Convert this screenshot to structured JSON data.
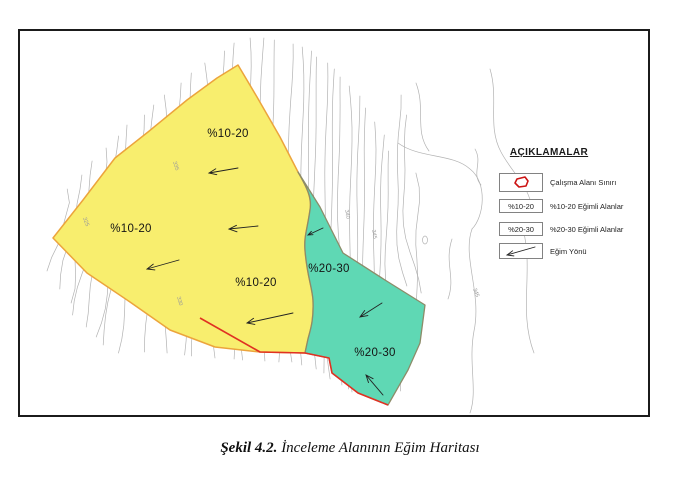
{
  "figure": {
    "caption_prefix": "Şekil 4.2.",
    "caption_title": " İnceleme Alanının Eğim Haritası"
  },
  "map": {
    "region_labels": [
      {
        "text": "%10-20"
      },
      {
        "text": "%10-20"
      },
      {
        "text": "%10-20"
      },
      {
        "text": "%20-30"
      },
      {
        "text": "%20-30"
      }
    ],
    "contour_labels": [
      {
        "text": "340"
      },
      {
        "text": "345"
      },
      {
        "text": "345"
      },
      {
        "text": "330"
      },
      {
        "text": "325"
      },
      {
        "text": "335"
      }
    ],
    "legend": {
      "title": "AÇIKLAMALAR",
      "items": [
        {
          "key": "",
          "label": "Çalışma Alanı Sınırı"
        },
        {
          "key": "%10-20",
          "label": "%10-20 Eğimli Alanlar"
        },
        {
          "key": "%20-30",
          "label": "%20-30 Eğimli Alanlar"
        },
        {
          "key": "",
          "label": "Eğim Yönü"
        }
      ]
    },
    "colors": {
      "slope_10_20_fill": "#f8ee6e",
      "slope_20_30_fill": "#5fd8b4",
      "boundary_red": "#e03122",
      "boundary_orange": "#eca43c",
      "region_20_30_edge": "#8c8c69",
      "contour_gray": "#b2b2b2",
      "legend_shape_red": "#cc1414"
    }
  }
}
